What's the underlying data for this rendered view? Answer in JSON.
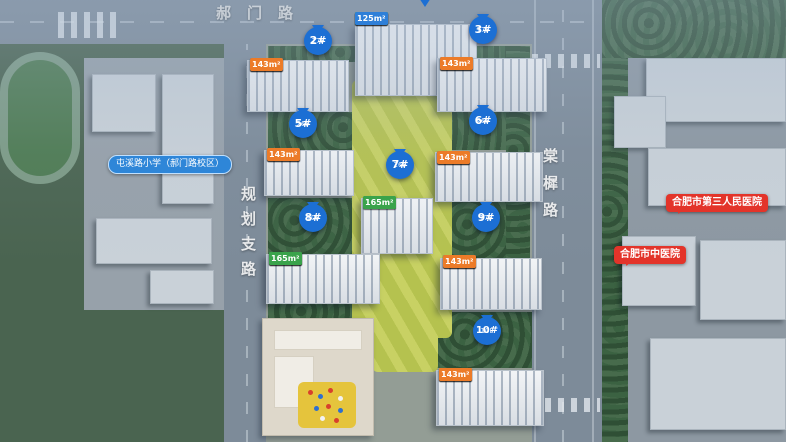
{
  "map": {
    "roads": {
      "top": "郝门路",
      "left": "规划支路",
      "right": "棠樨路"
    },
    "pois": {
      "school": {
        "label": "屯溪路小学（郝门路校区）"
      },
      "hospital_third": {
        "label": "合肥市第三人民医院"
      },
      "hospital_tcm": {
        "label": "合肥市中医院"
      }
    },
    "buildings": {
      "b1": {
        "tags": [
          {
            "text": "125m²",
            "type": "blue"
          },
          {
            "text": "165m²",
            "type": "green"
          },
          {
            "text": "165m²",
            "type": "green"
          },
          {
            "text": "125m²",
            "type": "blue"
          }
        ]
      },
      "b2": {
        "pin": "2#",
        "floors": "17F",
        "tags": [
          {
            "text": "143m²",
            "type": "orange"
          },
          {
            "text": "125m²",
            "type": "blue"
          },
          {
            "text": "125m²",
            "type": "blue"
          },
          {
            "text": "143m²",
            "type": "orange"
          }
        ]
      },
      "b3": {
        "pin": "3#",
        "floors": "17F",
        "tags": [
          {
            "text": "143m²",
            "type": "orange"
          },
          {
            "text": "125m²",
            "type": "blue"
          },
          {
            "text": "125m²",
            "type": "blue"
          },
          {
            "text": "143m²",
            "type": "orange"
          }
        ]
      },
      "b5": {
        "pin": "5#",
        "floors": "26F",
        "tags": [
          {
            "text": "143m²",
            "type": "orange"
          },
          {
            "text": "125m²",
            "type": "blue"
          },
          {
            "text": "125m²",
            "type": "blue"
          },
          {
            "text": "143m²",
            "type": "orange"
          }
        ]
      },
      "b6": {
        "pin": "6#",
        "floors": "26F",
        "tags": [
          {
            "text": "143m²",
            "type": "orange"
          },
          {
            "text": "125m²",
            "type": "blue"
          },
          {
            "text": "125m²",
            "type": "blue"
          },
          {
            "text": "143m²",
            "type": "orange"
          }
        ]
      },
      "b7": {
        "pin": "7#",
        "floors": "26F",
        "tags": [
          {
            "text": "165m²",
            "type": "green"
          },
          {
            "text": "165m²",
            "type": "green"
          }
        ]
      },
      "b8": {
        "pin": "8#",
        "floors": "10F",
        "tags": [
          {
            "text": "165m²",
            "type": "green"
          },
          {
            "text": "165m²",
            "type": "green"
          },
          {
            "text": "165m²",
            "type": "green"
          },
          {
            "text": "165m²",
            "type": "green"
          }
        ]
      },
      "b9": {
        "pin": "9#",
        "floors": "17F",
        "tags": [
          {
            "text": "143m²",
            "type": "orange"
          },
          {
            "text": "121m²",
            "type": "blue"
          },
          {
            "text": "125m²",
            "type": "blue"
          },
          {
            "text": "143m²",
            "type": "orange"
          }
        ]
      },
      "b10": {
        "pin": "10#",
        "floors": "10F",
        "tags": [
          {
            "text": "143m²",
            "type": "orange"
          },
          {
            "text": "143m²",
            "type": "orange"
          },
          {
            "text": "143m²",
            "type": "orange"
          },
          {
            "text": "143m²",
            "type": "orange"
          }
        ]
      }
    },
    "colors": {
      "pin_blue": "#1c6fd4",
      "tag_blue": "#2e7fd8",
      "tag_green": "#3aa34b",
      "tag_orange": "#ec7b28",
      "poi_red": "#e3342a",
      "poi_blue": "#2e86d8"
    }
  }
}
